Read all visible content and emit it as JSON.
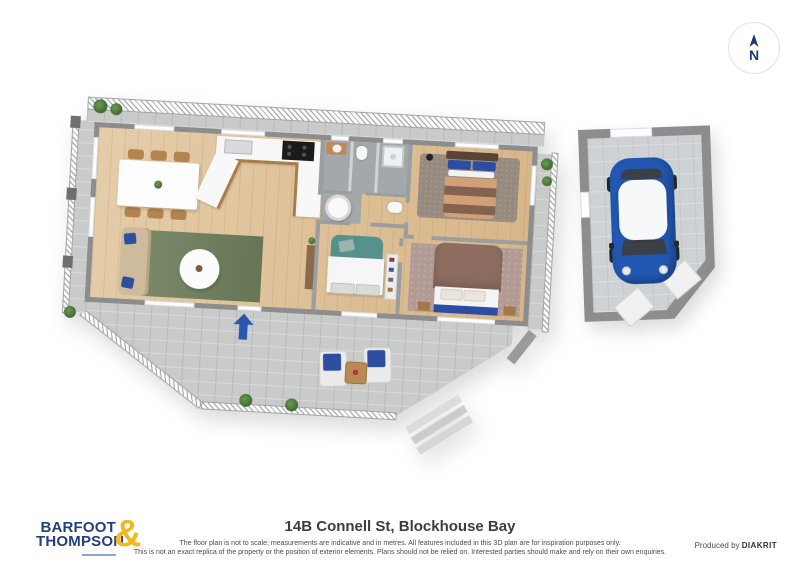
{
  "compass": {
    "label": "N"
  },
  "footer": {
    "logo": {
      "line1": "BARFOOT",
      "line2": "THOMPSON",
      "ampersand": "&"
    },
    "title": "14B Connell St, Blockhouse Bay",
    "disclaimer_line1": "The floor plan is not to scale; measurements are indicative and in metres. All features included in this 3D plan are for inspiration purposes only.",
    "disclaimer_line2": "This is not an exact replica of the property or the position of exterior elements. Plans should not be relied on. Interested parties should make and rely on their own enquiries.",
    "credit_prefix": "Produced by",
    "credit_brand": "DIAKRIT"
  },
  "palette": {
    "brand-navy": "#24407c",
    "brand-yellow": "#f2b725",
    "compass-navy": "#1d3a75",
    "arrow-blue": "#2a56ad",
    "car-blue": "#2257b2",
    "wood": "#debf92",
    "wall": "#8d8d8d",
    "paver": "#c9cbca",
    "rug-green": "#6f7f5c",
    "rug-mauve": "#b39b95",
    "rug-taupe": "#978b7f",
    "bed-teal": "#55928b",
    "pillow-blue": "#2c4da0",
    "sofa": "#cdbb9b"
  }
}
